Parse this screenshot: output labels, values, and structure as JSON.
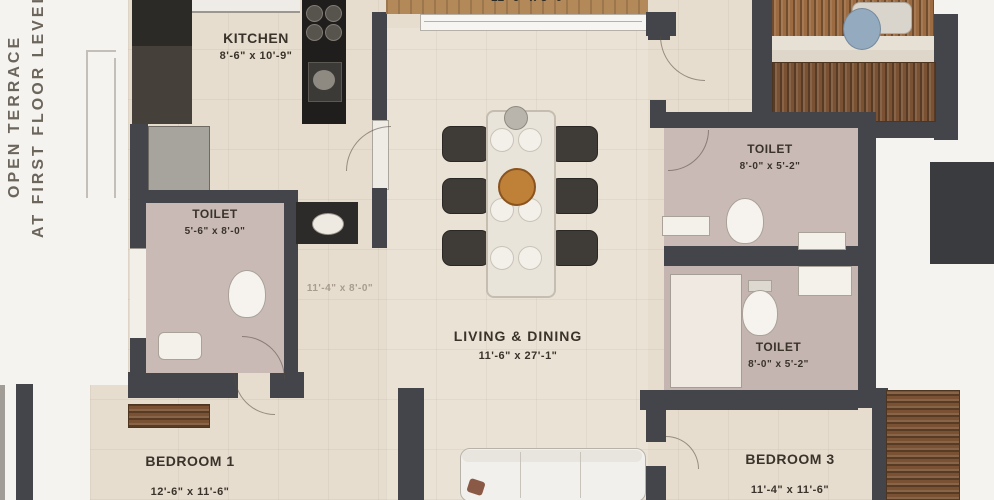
{
  "colors": {
    "wall": "#44454a",
    "floor_beige": "#e6ddcf",
    "toilet_floor": "#c9bab6",
    "terrace_white": "#f5f3ef",
    "wood_furniture": "#7a5233",
    "balcony_wood": "#b3895a",
    "kitchen_counter": "#1f1e1c",
    "label_text": "#3a332a"
  },
  "annotations": {
    "terrace_note_line1": "OPEN TERRACE",
    "terrace_note_line2": "AT FIRST FLOOR LEVEL",
    "balcony_dims_clipped": "11'-6\" x 5'-0\"",
    "passage_dims_faint": "11'-4\" x 8'-0\""
  },
  "rooms": {
    "kitchen": {
      "name": "KITCHEN",
      "dims": "8'-6\" x 10'-9\""
    },
    "toilet_left": {
      "name": "TOILET",
      "dims": "5'-6\" x 8'-0\""
    },
    "living_dining": {
      "name": "LIVING & DINING",
      "dims": "11'-6\" x 27'-1\""
    },
    "toilet_top_right": {
      "name": "TOILET",
      "dims": "8'-0\" x 5'-2\""
    },
    "toilet_mid_right": {
      "name": "TOILET",
      "dims": "8'-0\" x 5'-2\""
    },
    "bedroom_1": {
      "name": "BEDROOM 1",
      "dims": "12'-6\" x 11'-6\""
    },
    "bedroom_3": {
      "name": "BEDROOM 3",
      "dims": "11'-4\" x 11'-6\""
    }
  }
}
